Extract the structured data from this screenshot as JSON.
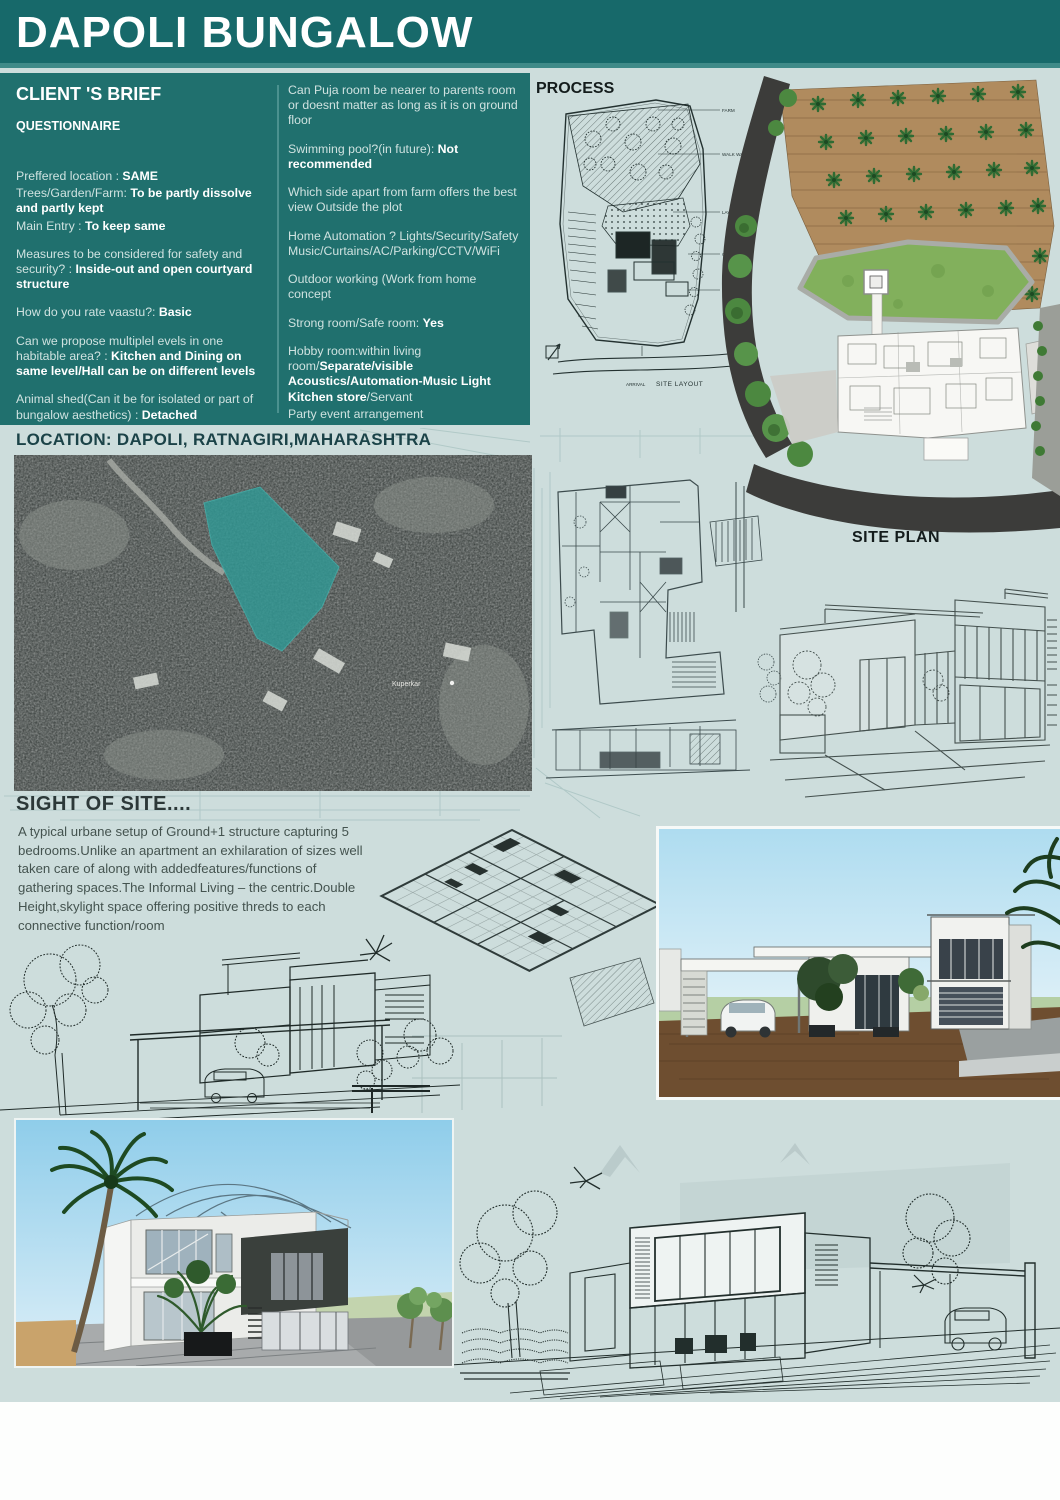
{
  "colors": {
    "header_teal": "#17696a",
    "panel_teal": "#20706e",
    "page_bg": "#cddddc",
    "plot_highlight_teal": "#2f9a96",
    "farm_brown": "#b08b5e",
    "lawn_green": "#82b05c",
    "road_dark": "#3c3c3a"
  },
  "header": {
    "title": "DAPOLI BUNGALOW"
  },
  "brief": {
    "title": "CLIENT 'S BRIEF",
    "subtitle": "QUESTIONNAIRE",
    "left": [
      {
        "pre": "Preffered location    : ",
        "bold": "SAME"
      },
      {
        "pre": "Trees/Garden/Farm: ",
        "bold": "To be partly dissolve and partly kept"
      },
      {
        "pre": "Main Entry             : ",
        "bold": "To keep same"
      },
      {
        "pre": "Measures to be considered for safety and security?            : ",
        "bold": "Inside-out and open courtyard structure"
      },
      {
        "pre": "How do you rate vaastu?: ",
        "bold": "Basic"
      },
      {
        "pre": "Can we propose multiplel evels in one habitable area? : ",
        "bold": "Kitchen and Dining on same level/Hall can be on different levels"
      },
      {
        "pre": "Animal shed(Can it be for isolated or part of bungalow aesthetics) : ",
        "bold": "Detached"
      },
      {
        "pre": "What is proposed plan/vision for Garden/Farm Flower garden/Trees with area"
      }
    ],
    "right": [
      {
        "pre": "Can Puja room be nearer to parents room or doesnt matter as long as it is on ground floor"
      },
      {
        "pre": "Swimming pool?(in future): ",
        "bold": "Not recommended"
      },
      {
        "pre": "Which side apart from farm offers the best view Outside the plot"
      },
      {
        "pre": "Home Automation ? Lights/Security/Safety Music/Curtains/AC/Parking/CCTV/WiFi"
      },
      {
        "pre": "Outdoor working (Work from home concept"
      },
      {
        "pre": "Strong room/Safe room: ",
        "bold": "Yes"
      },
      {
        "pre": "Hobby room:within living room/",
        "bold": "Separate/visible Acoustics/Automation-Music Light Kitchen store",
        "post": "/Servant"
      },
      {
        "pre": "Party event arrangement"
      },
      {
        "pre": "Dish Antenna"
      },
      {
        "pre": "Garage:closed/open"
      },
      {
        "pre": "Any intention of Business cottage? for entry"
      },
      {
        "pre": "Solar"
      },
      {
        "pre": "Farming equipments/vegetable store/Harvest season store arrangement: ",
        "bold": "Required"
      }
    ]
  },
  "process": {
    "label": "PROCESS",
    "site_layout_caption": "SITE LAYOUT",
    "site_plan_caption": "SITE PLAN",
    "sketch_labels": [
      "FARM",
      "WALK WAY",
      "LAWN",
      "GARAGE",
      "POOL",
      "ARRIVAL"
    ],
    "north_label": "N"
  },
  "location": {
    "label": "LOCATION: DAPOLI, RATNAGIRI,MAHARASHTRA",
    "map_pin_label": "Kuperkar"
  },
  "sight": {
    "title": "SIGHT OF SITE....",
    "body": "A typical urbane setup of Ground+1 structure capturing 5 bedrooms.Unlike an apartment an exhilaration of sizes well taken care of along with addedfeatures/functions  of gathering spaces.The Informal Living – the centric.Double Height,skylight space offering positive threds to each connective function/room"
  }
}
